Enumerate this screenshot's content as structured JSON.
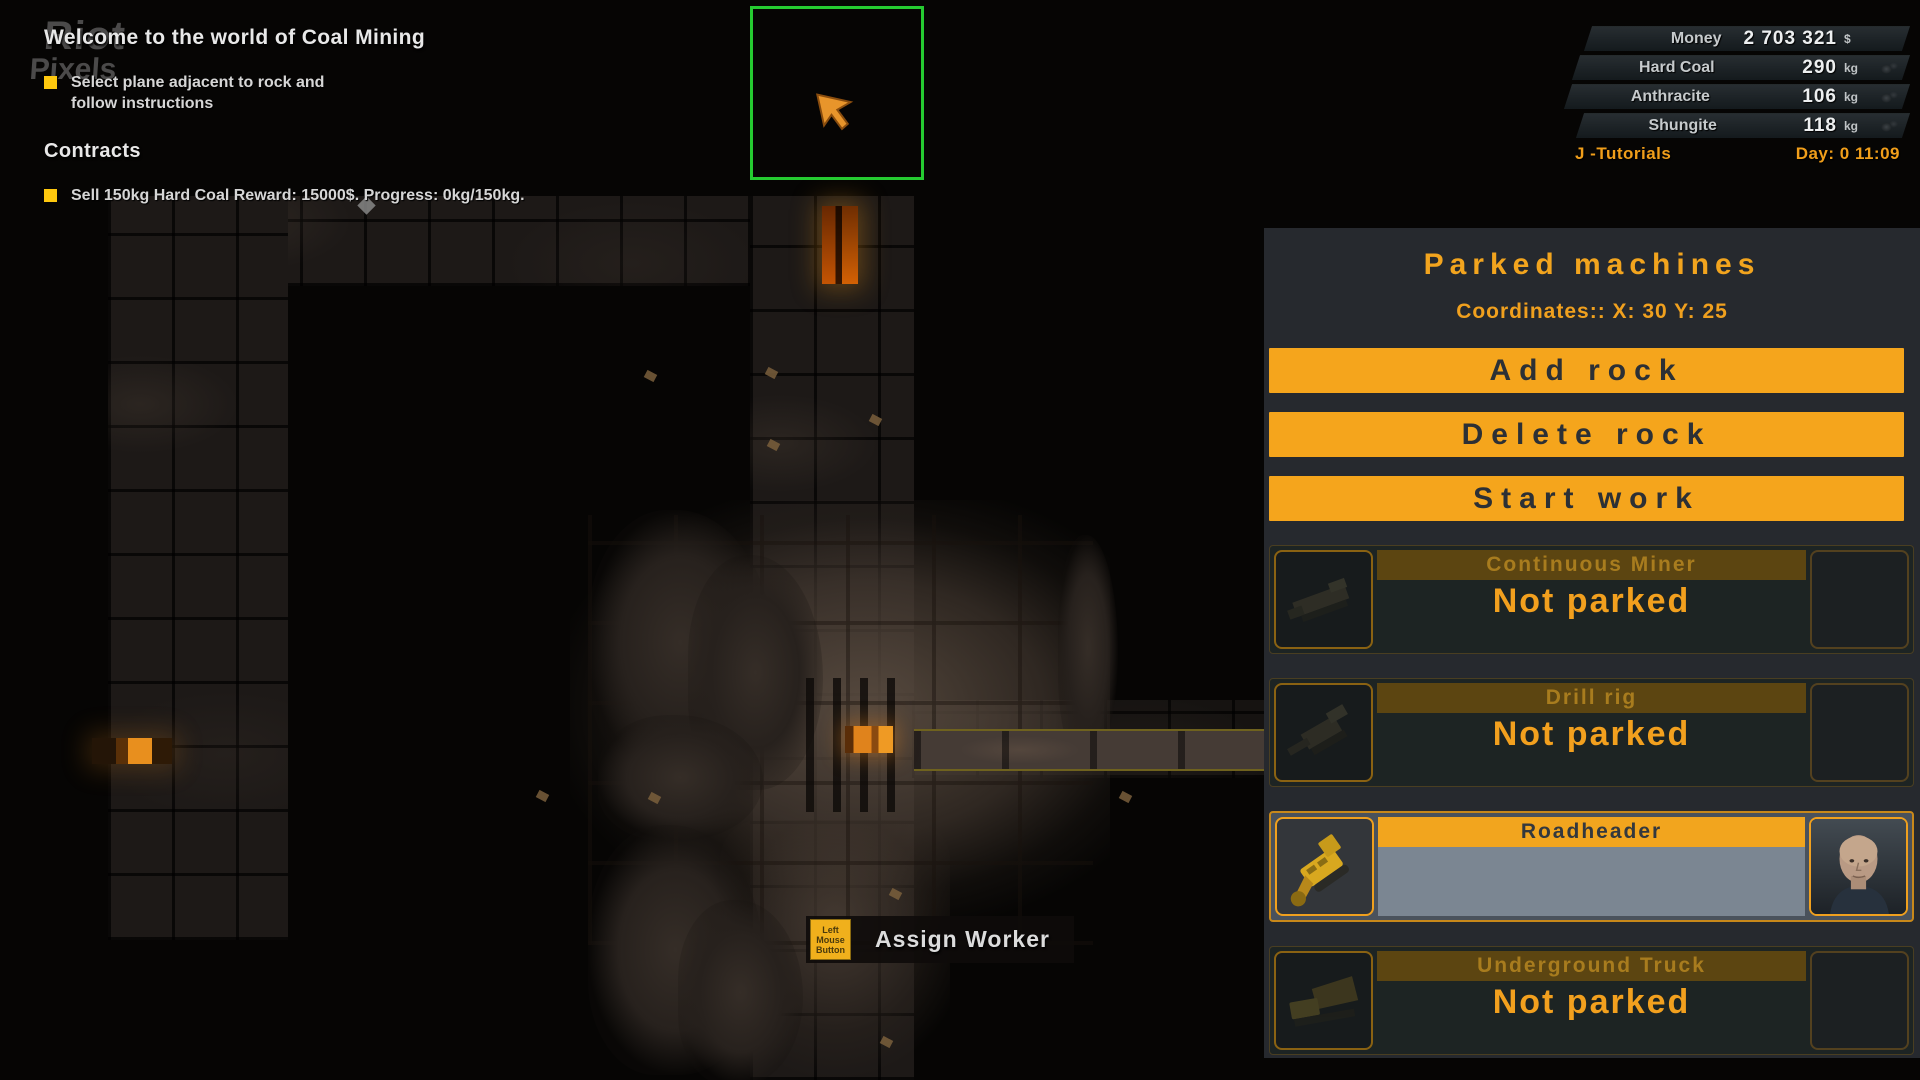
{
  "watermark": {
    "line1": "Riot",
    "line2": "Pixels"
  },
  "tutorial": {
    "title": "Welcome to the world of Coal Mining",
    "instruction": "Select plane adjacent to rock and follow instructions",
    "contracts_title": "Contracts",
    "contract_text": "Sell 150kg Hard Coal Reward: 15000$. Progress: 0kg/150kg."
  },
  "resources": {
    "rows": [
      {
        "label": "Money",
        "value": "2 703 321",
        "unit": "$"
      },
      {
        "label": "Hard Coal",
        "value": "290",
        "unit": "kg"
      },
      {
        "label": "Anthracite",
        "value": "106",
        "unit": "kg"
      },
      {
        "label": "Shungite",
        "value": "118",
        "unit": "kg"
      }
    ],
    "footer_left": "J -Tutorials",
    "footer_right": "Day: 0 11:09"
  },
  "parked_panel": {
    "title": "Parked machines",
    "coordinates": "Coordinates:: X: 30 Y: 25",
    "buttons": [
      "Add rock",
      "Delete rock",
      "Start work"
    ],
    "machines": [
      {
        "name": "Continuous Miner",
        "status": "Not parked"
      },
      {
        "name": "Drill rig",
        "status": "Not parked"
      },
      {
        "name": "Roadheader",
        "status": ""
      },
      {
        "name": "Underground Truck",
        "status": "Not parked"
      }
    ]
  },
  "tooltip": {
    "key_hint": "Left Mouse Button",
    "label": "Assign Worker"
  },
  "colors": {
    "accent": "#F5A51C",
    "selection": "#25CB31",
    "panel": "#26292E"
  }
}
